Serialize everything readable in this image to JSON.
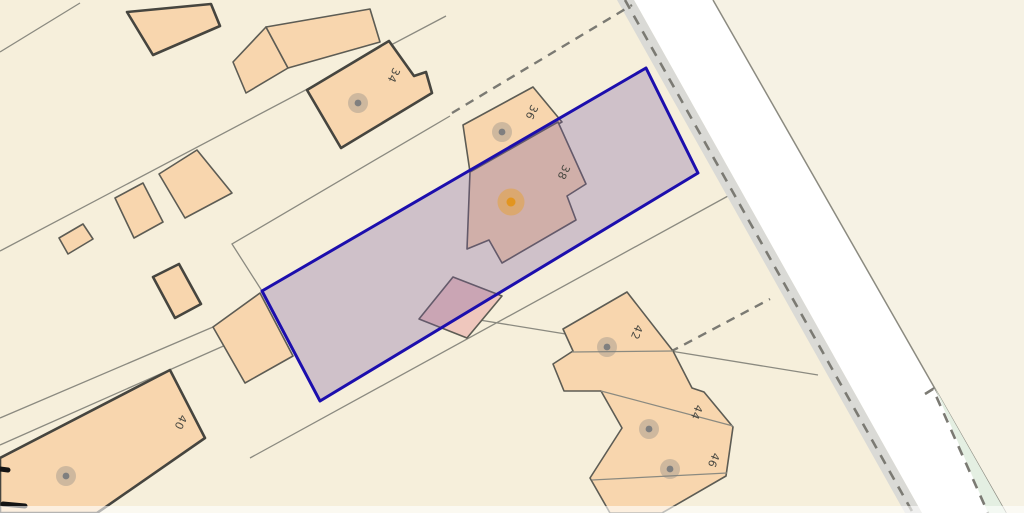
{
  "map": {
    "width": 1024,
    "height": 513,
    "colors": {
      "background": "#f6efdb",
      "background_far_side": "#f6f2e4",
      "road_surface": "#ffffff",
      "verge_fill": "#dadad6",
      "green_verge_fill": "#e4efe2",
      "building_fill": "#f8d6ae",
      "outbuilding_fill": "#efc7bd",
      "building_outline": "#5d5c54",
      "building_outline_emphasis": "#46453f",
      "boundary_line": "#8b8a80",
      "dash_line": "#7b7a73",
      "label_color": "#4b4a43",
      "parcel_stroke": "#1c0ead",
      "parcel_fill": "rgba(117,85,160,0.30)",
      "marker_gray": "#7f7f7f",
      "marker_gray_halo": "rgba(130,130,130,0.35)",
      "marker_orange": "#e2951f",
      "marker_orange_halo": "rgba(233,160,40,0.45)",
      "black_mark": "#141414"
    },
    "road": {
      "verge_polygon": [
        [
          617,
          0
        ],
        [
          634,
          0
        ],
        [
          922,
          513
        ],
        [
          905,
          513
        ]
      ],
      "surface_polygon": [
        [
          634,
          0
        ],
        [
          713,
          0
        ],
        [
          1006,
          513
        ],
        [
          922,
          513
        ]
      ],
      "far_side_polygon": [
        [
          713,
          0
        ],
        [
          1024,
          0
        ],
        [
          1024,
          513
        ],
        [
          1006,
          513
        ]
      ],
      "edge_line": [
        [
          713,
          0
        ],
        [
          1006,
          513
        ]
      ],
      "verge_dash_line": [
        [
          625,
          0
        ],
        [
          913,
          513
        ]
      ],
      "green_verge_polygon": [
        [
          935,
          388
        ],
        [
          988,
          513
        ],
        [
          1006,
          513
        ]
      ],
      "green_verge_dash": [
        [
          925,
          394
        ],
        [
          933,
          389
        ],
        [
          988,
          513
        ]
      ]
    },
    "boundary_lines_under": [
      [
        [
          0,
          251
        ],
        [
          446,
          16
        ]
      ],
      [
        [
          0,
          52
        ],
        [
          80,
          3
        ]
      ],
      [
        [
          0,
          418
        ],
        [
          213,
          327
        ]
      ],
      [
        [
          0,
          445
        ],
        [
          228,
          344
        ]
      ],
      [
        [
          450,
          116
        ],
        [
          232,
          244
        ],
        [
          262,
          291
        ]
      ],
      [
        [
          250,
          458
        ],
        [
          728,
          196
        ]
      ],
      [
        [
          461,
          317
        ],
        [
          818,
          375
        ]
      ]
    ],
    "boundary_lines_over": [
      [
        [
          572,
          352
        ],
        [
          673,
          351
        ]
      ],
      [
        [
          601,
          391
        ],
        [
          733,
          426
        ]
      ],
      [
        [
          592,
          480
        ],
        [
          727,
          473
        ]
      ]
    ],
    "dashed_lines": [
      [
        [
          452,
          113
        ],
        [
          632,
          5
        ]
      ],
      [
        [
          670,
          352
        ],
        [
          770,
          299
        ]
      ]
    ],
    "buildings": [
      {
        "id": "building-top-left",
        "emphasis": true,
        "points": [
          [
            127,
            12
          ],
          [
            211,
            4
          ],
          [
            220,
            26
          ],
          [
            153,
            55
          ]
        ]
      },
      {
        "id": "building-pair-small",
        "emphasis": false,
        "points": [
          [
            233,
            62
          ],
          [
            266,
            27
          ],
          [
            288,
            68
          ],
          [
            246,
            93
          ]
        ]
      },
      {
        "id": "building-pair-large",
        "emphasis": false,
        "points": [
          [
            266,
            27
          ],
          [
            370,
            9
          ],
          [
            380,
            42
          ],
          [
            288,
            68
          ]
        ]
      },
      {
        "id": "building-34",
        "emphasis": true,
        "points": [
          [
            307,
            90
          ],
          [
            389,
            41
          ],
          [
            414,
            76
          ],
          [
            426,
            72
          ],
          [
            432,
            93
          ],
          [
            341,
            148
          ]
        ]
      },
      {
        "id": "building-mid-small-1",
        "emphasis": false,
        "points": [
          [
            115,
            198
          ],
          [
            143,
            183
          ],
          [
            163,
            222
          ],
          [
            134,
            238
          ]
        ]
      },
      {
        "id": "building-mid-small-2",
        "emphasis": false,
        "points": [
          [
            159,
            174
          ],
          [
            197,
            150
          ],
          [
            232,
            193
          ],
          [
            185,
            218
          ]
        ]
      },
      {
        "id": "building-tiny",
        "emphasis": false,
        "points": [
          [
            59,
            238
          ],
          [
            83,
            224
          ],
          [
            93,
            239
          ],
          [
            68,
            254
          ]
        ]
      },
      {
        "id": "building-rect-mid",
        "emphasis": true,
        "points": [
          [
            153,
            277
          ],
          [
            179,
            264
          ],
          [
            201,
            304
          ],
          [
            175,
            318
          ]
        ]
      },
      {
        "id": "building-at-parcel-corner",
        "emphasis": false,
        "points": [
          [
            213,
            327
          ],
          [
            260,
            293
          ],
          [
            293,
            356
          ],
          [
            245,
            383
          ]
        ]
      },
      {
        "id": "building-36",
        "emphasis": false,
        "points": [
          [
            463,
            125
          ],
          [
            533,
            87
          ],
          [
            562,
            122
          ],
          [
            470,
            172
          ]
        ]
      },
      {
        "id": "building-38",
        "emphasis": false,
        "points": [
          [
            470,
            172
          ],
          [
            558,
            122
          ],
          [
            586,
            184
          ],
          [
            567,
            196
          ],
          [
            576,
            220
          ],
          [
            502,
            263
          ],
          [
            489,
            240
          ],
          [
            467,
            249
          ]
        ]
      },
      {
        "id": "building-40",
        "emphasis": true,
        "points": [
          [
            170,
            370
          ],
          [
            205,
            438
          ],
          [
            97,
            513
          ],
          [
            0,
            513
          ],
          [
            0,
            458
          ]
        ]
      },
      {
        "id": "outbuilding-38",
        "emphasis": false,
        "outbuilding": true,
        "points": [
          [
            419,
            319
          ],
          [
            453,
            277
          ],
          [
            502,
            296
          ],
          [
            467,
            338
          ]
        ]
      },
      {
        "id": "terrace-42-44-46",
        "emphasis": false,
        "points": [
          [
            563,
            329
          ],
          [
            627,
            292
          ],
          [
            673,
            351
          ],
          [
            692,
            388
          ],
          [
            704,
            392
          ],
          [
            733,
            427
          ],
          [
            726,
            476
          ],
          [
            662,
            513
          ],
          [
            610,
            513
          ],
          [
            590,
            478
          ],
          [
            622,
            428
          ],
          [
            601,
            391
          ],
          [
            564,
            391
          ],
          [
            553,
            364
          ],
          [
            573,
            351
          ]
        ]
      }
    ],
    "parcel": {
      "points": [
        [
          262,
          291
        ],
        [
          646,
          68
        ],
        [
          698,
          173
        ],
        [
          320,
          401
        ]
      ]
    },
    "markers": [
      {
        "id": "34",
        "x": 358,
        "y": 103,
        "type": "gray"
      },
      {
        "id": "36",
        "x": 502,
        "y": 132,
        "type": "gray"
      },
      {
        "id": "38",
        "x": 511,
        "y": 202,
        "type": "orange"
      },
      {
        "id": "40",
        "x": 66,
        "y": 476,
        "type": "gray"
      },
      {
        "id": "42",
        "x": 607,
        "y": 347,
        "type": "gray"
      },
      {
        "id": "44",
        "x": 649,
        "y": 429,
        "type": "gray"
      },
      {
        "id": "46",
        "x": 670,
        "y": 469,
        "type": "gray"
      }
    ],
    "labels": [
      {
        "text": "34",
        "x": 393,
        "y": 75,
        "rotation": 115
      },
      {
        "text": "36",
        "x": 531,
        "y": 112,
        "rotation": 115
      },
      {
        "text": "38",
        "x": 563,
        "y": 172,
        "rotation": 115
      },
      {
        "text": "40",
        "x": 180,
        "y": 422,
        "rotation": 115
      },
      {
        "text": "42",
        "x": 636,
        "y": 332,
        "rotation": 112
      },
      {
        "text": "44",
        "x": 696,
        "y": 412,
        "rotation": 112
      },
      {
        "text": "46",
        "x": 713,
        "y": 460,
        "rotation": 112
      }
    ],
    "black_marks": [
      [
        [
          0,
          469
        ],
        [
          8,
          470
        ]
      ],
      [
        [
          3,
          504
        ],
        [
          25,
          506
        ]
      ]
    ]
  }
}
